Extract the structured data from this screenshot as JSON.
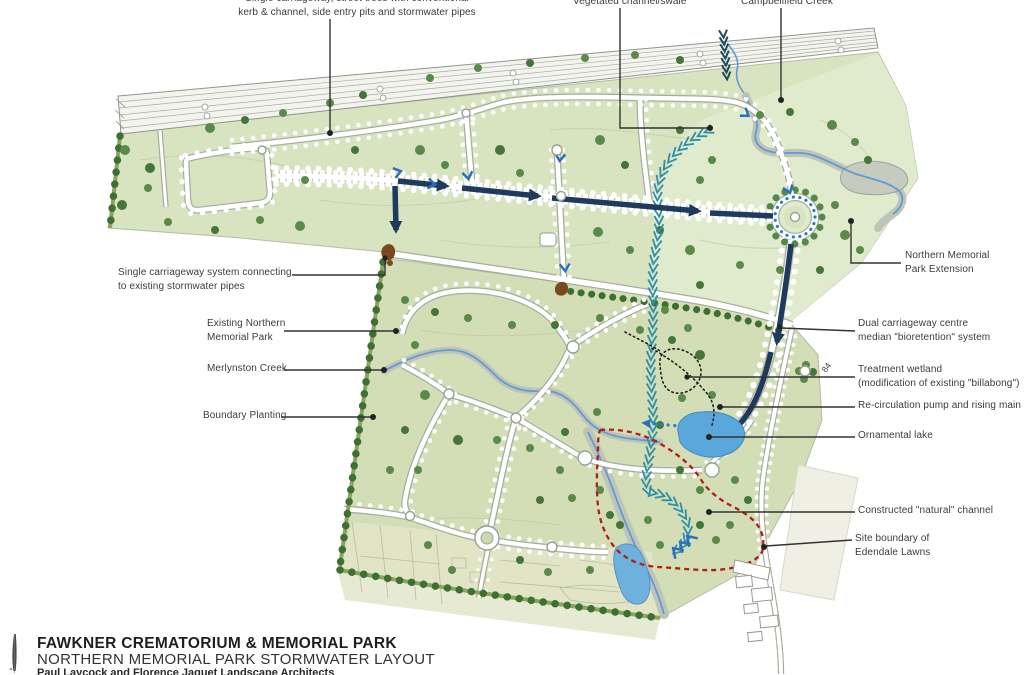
{
  "map": {
    "annotations": {
      "top": [
        {
          "id": "single-carriageway-street-trees",
          "text": "Single carriageway, street trees with conventional\nkerb & channel, side entry pits and stormwater pipes"
        },
        {
          "id": "vegetated-channel",
          "text": "Vegetated channel/swale"
        },
        {
          "id": "campbellfield-creek",
          "text": "Campbellfield Creek"
        }
      ],
      "left": [
        {
          "id": "single-carriageway-system",
          "text": "Single carriageway system connecting\nto existing stormwater pipes"
        },
        {
          "id": "existing-northern-memorial-park",
          "text": "Existing Northern\nMemorial Park"
        },
        {
          "id": "merlynston-creek",
          "text": "Merlynston Creek"
        },
        {
          "id": "boundary-planting",
          "text": "Boundary Planting"
        }
      ],
      "right": [
        {
          "id": "northern-memorial-park-extension",
          "text": "Northern Memorial\nPark Extension"
        },
        {
          "id": "dual-carriageway-bioretention",
          "text": "Dual carriageway centre\nmedian \"bioretention\" system"
        },
        {
          "id": "treatment-wetland",
          "text": "Treatment wetland\n(modification of existing \"billabong\")"
        },
        {
          "id": "recirculation-pump",
          "text": "Re-circulation pump and rising main"
        },
        {
          "id": "ornamental-lake",
          "text": "Ornamental lake"
        },
        {
          "id": "constructed-natural-channel",
          "text": "Constructed \"natural\" channel"
        },
        {
          "id": "site-boundary-edendale",
          "text": "Site boundary of\nEdendale Lawns"
        }
      ],
      "plan_note": "84"
    },
    "features": {
      "creeks": [
        "Campbellfield Creek",
        "Merlynston Creek"
      ],
      "water_bodies": [
        "Ornamental lake",
        "Treatment wetland",
        "Pond"
      ],
      "parcels": [
        "Northern Memorial Park Extension",
        "Existing Northern Memorial Park",
        "Edendale Lawns"
      ]
    }
  },
  "title_block": {
    "line1": "FAWKNER CREMATORIUM & MEMORIAL PARK",
    "line2": "NORTHERN MEMORIAL PARK STORMWATER LAYOUT",
    "line3": "Paul Laycock and Florence Jaquet Landscape Architects"
  },
  "colors": {
    "extension_parcel": "#d8e3c0",
    "extension_parcel_light": "#e0eacc",
    "existing_parcel": "#d3deb6",
    "lowland_parcel": "#e1e5c6",
    "pale_wedge": "#efefe3",
    "tree_green": "#5a8a49",
    "boundary_planting_green": "#3e7034",
    "swale_blue": "#2d7dc5",
    "flow_navy": "#1e3a5c",
    "channel_teal": "#2f8fa8",
    "creek_blue": "#5f9bd4",
    "creek_gray": "#bfc4b8",
    "lake_blue": "#5aa7dc",
    "site_boundary_red": "#b01f14",
    "pipe_brown": "#7b4a1c",
    "leader_black": "#333333"
  }
}
